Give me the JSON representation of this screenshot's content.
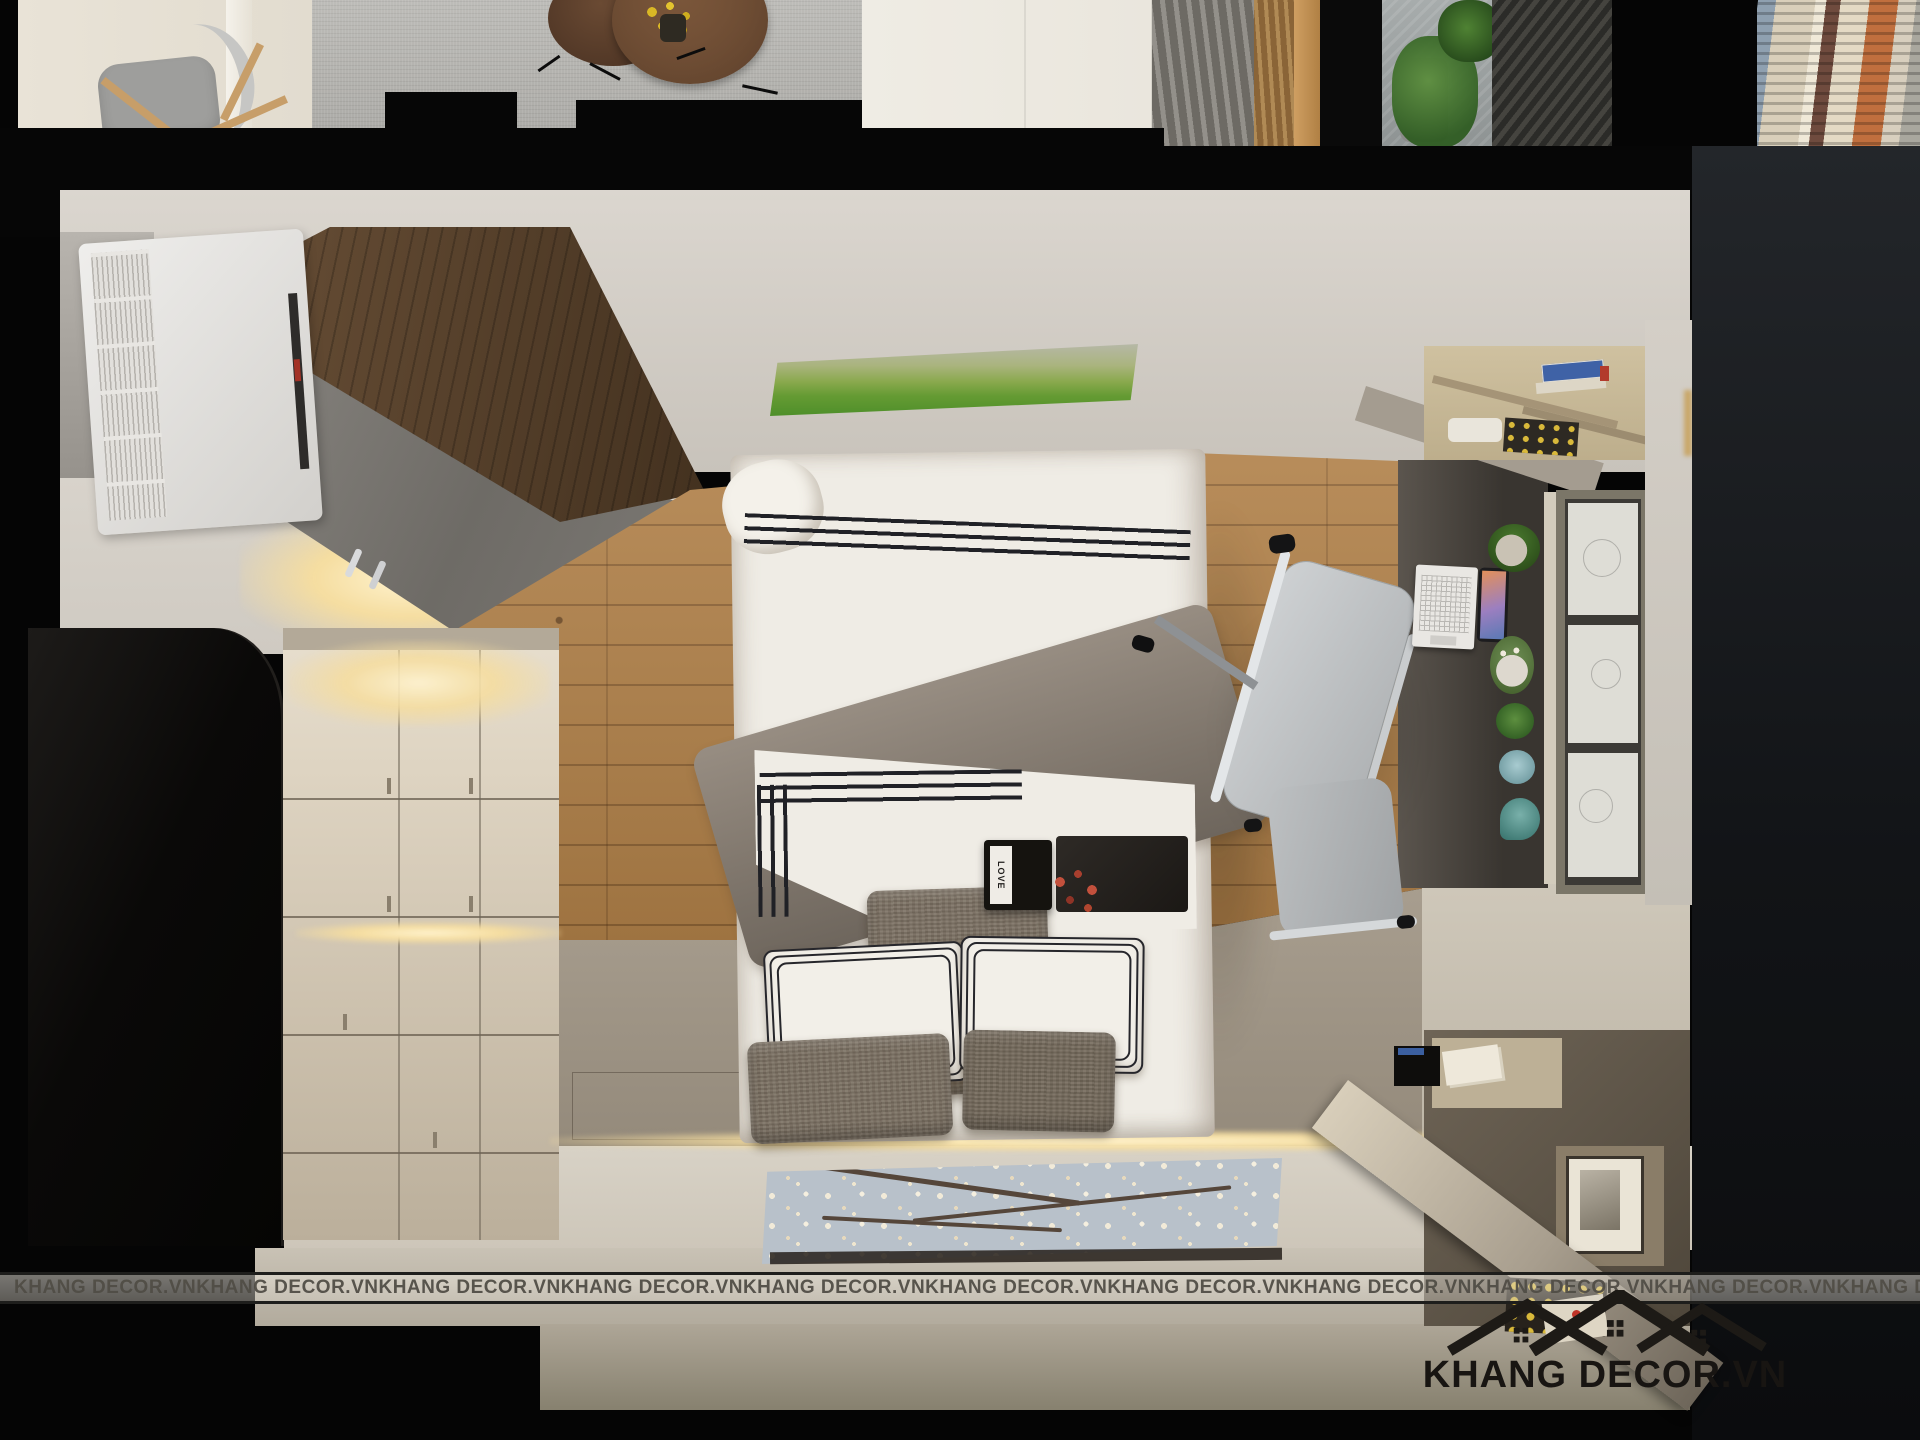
{
  "branding": {
    "watermark_text": "KHANG DECOR.VN",
    "watermark_repeat": 13,
    "logo_text": "KHANG DECOR.VN",
    "logo_icon": "three-house-roofs-icon",
    "logo_color": "#1d1a16",
    "watermark_band_color": "#e8e4dc"
  },
  "decor": {
    "love_box_label": "LOVE"
  },
  "palette": {
    "frame_black": "#050505",
    "oak_floor": "#b08048",
    "walnut_panel": "#5a4531",
    "cream_floor": "#d6d0c4",
    "cabinet_cream": "#ddd3c2",
    "wardrobe_black": "#0d0c0b",
    "right_wardrobe_charcoal": "#17191c",
    "bed_linen_white": "#efece5",
    "blanket_gray": "#8b8178",
    "pillow_brown": "#7c7163",
    "led_glow": "#ffe9b8",
    "picture_green": "#659b33",
    "mat_blue_gray": "#b8c1ca"
  }
}
